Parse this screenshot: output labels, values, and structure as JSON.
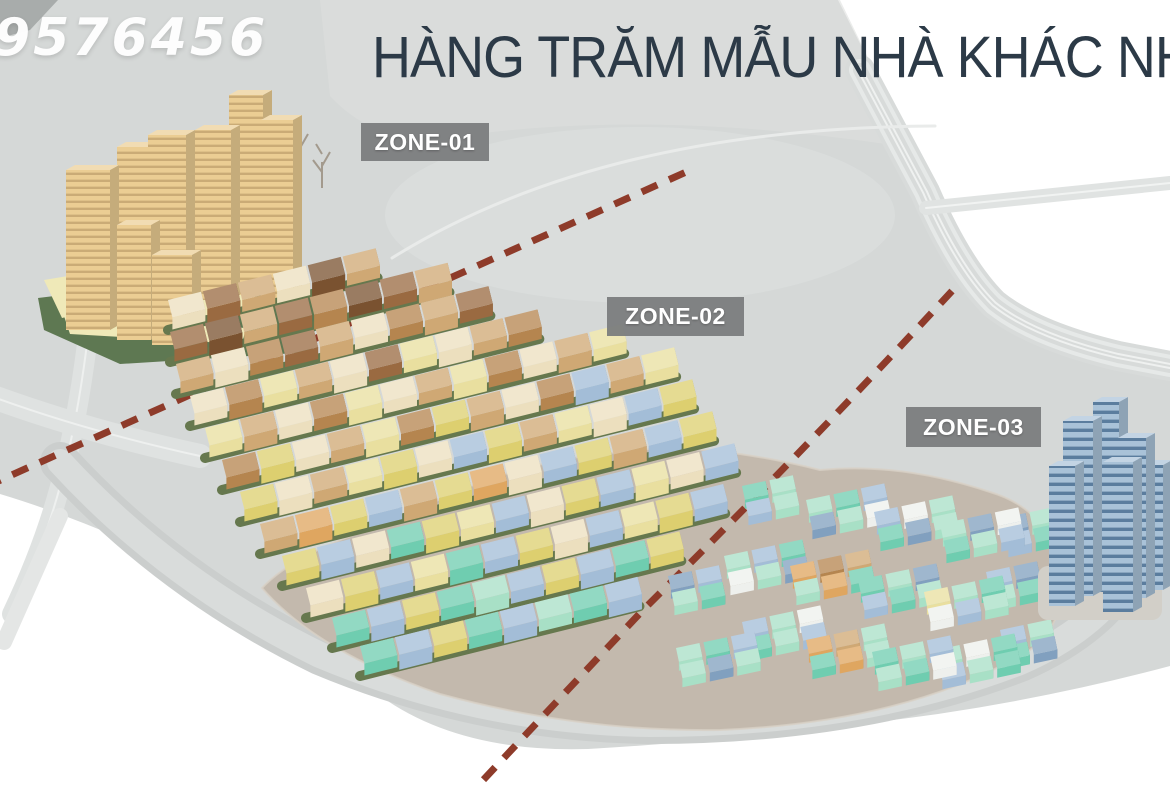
{
  "watermark": {
    "text": "9576456"
  },
  "title": {
    "text": "HÀNG TRĂM MẪU NHÀ KHÁC NHAU",
    "color": "#2c3a47"
  },
  "zone_labels": [
    {
      "id": "zone-01",
      "label": "ZONE-01"
    },
    {
      "id": "zone-02",
      "label": "ZONE-02"
    },
    {
      "id": "zone-03",
      "label": "ZONE-03"
    }
  ],
  "palette": {
    "cream": "#ecdfbe",
    "tan": "#cfa874",
    "caramel": "#b5854f",
    "brown": "#9a6a41",
    "chocolate": "#7a5230",
    "paleYellow": "#e9df9f",
    "yellow": "#ddcf6f",
    "blue": "#a3bdd7",
    "slate": "#81a0bf",
    "teal": "#6fcdb0",
    "mint": "#a8e0c6",
    "white": "#eef0ed",
    "orange": "#dfa660",
    "beige": "#ebcd93",
    "blueGlass": "#a9c2d8"
  },
  "scene": {
    "ground": {
      "plate": "M0,0 L838,0 L920,162 Q956,252 988,298 Q1028,334 1116,357 L1170,369 L1170,666 Q1058,696 938,714 Q758,739 588,749 Q455,753 375,692 Q288,640 178,564 Q80,518 0,494 Z",
      "plateColor": "#d5d8d7",
      "patches": [
        {
          "d": "M0,0 L58,0 L30,30 L0,38 Z",
          "fill": "#a8acab",
          "opacity": 1
        },
        {
          "d": "M320,0 L840,0 L912,148 Q660,108 460,136 Q380,150 330,96 Z",
          "fill": "#dddfde",
          "opacity": 0.6
        }
      ],
      "field": {
        "cx": 640,
        "cy": 215,
        "rx": 255,
        "ry": 88,
        "fill": "#dcdfde",
        "opacity": 0.7
      }
    },
    "roads": [
      {
        "d": "M860,70 L925,192 Q958,268 994,304 Q1034,336 1118,356 L1170,366",
        "layers": [
          [
            "#d8dbda",
            30
          ],
          [
            "#e6e9e8",
            22
          ],
          [
            "#d8dbda",
            14
          ],
          [
            "#eff1f0",
            6
          ],
          [
            "#d8dbda",
            2
          ]
        ]
      },
      {
        "d": "M926,208 L1170,183",
        "layers": [
          [
            "#e0e3e2",
            14
          ],
          [
            "#f1f3f2",
            2
          ]
        ]
      },
      {
        "d": "M96,256 Q86,380 66,462 Q50,534 12,614",
        "layers": [
          [
            "#dfe2e1",
            20
          ],
          [
            "#eef0ef",
            2
          ]
        ]
      },
      {
        "d": "M-4,398 Q90,432 200,456",
        "layers": [
          [
            "#dfe2e1",
            24
          ],
          [
            "#eef0ef",
            2
          ]
        ]
      },
      {
        "d": "M392,258 Q600,128 935,126",
        "layers": [
          [
            "#e9ebea",
            3
          ]
        ]
      },
      {
        "d": "M60,516 L4,642",
        "layers": [
          [
            "#e4e6e5",
            16
          ]
        ]
      },
      {
        "d": "M60,462 Q170,582 320,655 Q480,722 650,724 Q860,724 1020,662 Q1098,628 1130,572",
        "layers": [
          [
            "#cbcecd",
            40
          ],
          [
            "#d9dcdb",
            26
          ]
        ]
      }
    ],
    "podium": {
      "d": "M262,588 Q318,652 440,694 Q580,732 720,730 Q910,722 1030,650 Q1068,622 1060,570 Q1050,510 990,492 Q900,462 820,470 Q700,440 620,452 Q500,462 400,520 Q300,548 262,588 Z",
      "fill": "#c3b9ad"
    },
    "towerBase": {
      "green": "M38,298 L250,272 L318,300 L312,352 L120,364 L44,330 Z",
      "greenColor": "#5e7852",
      "slabs": [
        "M44,280 L116,268 L128,302 L62,318 Z",
        "M148,296 L252,288 L260,310 L156,320 Z",
        "M64,316 L246,328 L242,344 L70,334 Z"
      ],
      "slabColor": "#efe9b8"
    },
    "boundaries": {
      "color": "#8e3b2a",
      "width": 7,
      "dash": "17 13",
      "lines": [
        {
          "d": "M-15,487 L695,168"
        },
        {
          "d": "M952,291 Q800,455 645,608 Q558,700 472,792"
        }
      ]
    },
    "trees": [
      {
        "x": 300,
        "y": 170
      },
      {
        "x": 322,
        "y": 188
      },
      {
        "x": 290,
        "y": 205
      }
    ],
    "beigeTowers": [
      {
        "cx": 246,
        "base": 295,
        "w": 34,
        "h": 200
      },
      {
        "cx": 277,
        "base": 300,
        "w": 32,
        "h": 180
      },
      {
        "cx": 213,
        "base": 300,
        "w": 36,
        "h": 170
      },
      {
        "cx": 135,
        "base": 302,
        "w": 36,
        "h": 155
      },
      {
        "cx": 167,
        "base": 320,
        "w": 38,
        "h": 185
      },
      {
        "cx": 88,
        "base": 330,
        "w": 44,
        "h": 160
      },
      {
        "cx": 134,
        "base": 340,
        "w": 34,
        "h": 115
      },
      {
        "cx": 172,
        "base": 345,
        "w": 40,
        "h": 90
      }
    ],
    "rowAngle": -14,
    "house": {
      "w": 34,
      "d": 18,
      "h": 12,
      "gap": 2
    },
    "rows": [
      {
        "x": 168,
        "y": 300,
        "n": 6,
        "pal": [
          "cream",
          "brown",
          "tan",
          "cream",
          "chocolate",
          "tan"
        ]
      },
      {
        "x": 170,
        "y": 332,
        "n": 8,
        "pal": [
          "brown",
          "chocolate",
          "tan",
          "brown",
          "caramel",
          "chocolate",
          "brown",
          "tan"
        ]
      },
      {
        "x": 176,
        "y": 364,
        "n": 9,
        "pal": [
          "tan",
          "cream",
          "caramel",
          "brown",
          "tan",
          "cream",
          "caramel",
          "tan",
          "brown"
        ]
      },
      {
        "x": 190,
        "y": 396,
        "n": 10,
        "pal": [
          "cream",
          "caramel",
          "paleYellow",
          "tan",
          "cream",
          "brown",
          "paleYellow",
          "cream",
          "tan",
          "caramel"
        ]
      },
      {
        "x": 205,
        "y": 428,
        "n": 12,
        "pal": [
          "paleYellow",
          "tan",
          "cream",
          "caramel",
          "paleYellow",
          "cream",
          "tan",
          "paleYellow",
          "caramel",
          "cream",
          "tan",
          "paleYellow"
        ]
      },
      {
        "x": 222,
        "y": 460,
        "n": 13,
        "pal": [
          "caramel",
          "yellow",
          "cream",
          "tan",
          "paleYellow",
          "caramel",
          "yellow",
          "tan",
          "cream",
          "caramel",
          "blue",
          "tan",
          "paleYellow"
        ]
      },
      {
        "x": 240,
        "y": 492,
        "n": 13,
        "pal": [
          "yellow",
          "cream",
          "tan",
          "paleYellow",
          "yellow",
          "cream",
          "blue",
          "yellow",
          "tan",
          "paleYellow",
          "cream",
          "blue",
          "yellow"
        ]
      },
      {
        "x": 260,
        "y": 524,
        "n": 13,
        "pal": [
          "tan",
          "orange",
          "yellow",
          "blue",
          "tan",
          "yellow",
          "orange",
          "cream",
          "blue",
          "yellow",
          "tan",
          "blue",
          "yellow"
        ]
      },
      {
        "x": 282,
        "y": 556,
        "n": 13,
        "pal": [
          "yellow",
          "blue",
          "cream",
          "teal",
          "yellow",
          "paleYellow",
          "blue",
          "cream",
          "yellow",
          "blue",
          "paleYellow",
          "cream",
          "blue"
        ]
      },
      {
        "x": 306,
        "y": 588,
        "n": 12,
        "pal": [
          "cream",
          "yellow",
          "blue",
          "paleYellow",
          "teal",
          "blue",
          "yellow",
          "cream",
          "blue",
          "paleYellow",
          "yellow",
          "blue"
        ]
      },
      {
        "x": 332,
        "y": 618,
        "n": 10,
        "pal": [
          "teal",
          "blue",
          "yellow",
          "teal",
          "mint",
          "blue",
          "yellow",
          "blue",
          "teal",
          "yellow"
        ]
      },
      {
        "x": 360,
        "y": 646,
        "n": 8,
        "pal": [
          "teal",
          "blue",
          "yellow",
          "teal",
          "blue",
          "mint",
          "teal",
          "blue"
        ]
      }
    ],
    "clusterAngle": -12,
    "clusterHouse": {
      "w": 24,
      "d": 14,
      "h": 9,
      "sx": 28,
      "sy": 17
    },
    "clusters": [
      {
        "x": 676,
        "y": 648,
        "cols": 3,
        "rows": 2,
        "pal": [
          "mint",
          "teal",
          "blue",
          "mint",
          "slate",
          "mint"
        ]
      },
      {
        "x": 742,
        "y": 622,
        "cols": 3,
        "rows": 2,
        "pal": [
          "blue",
          "mint",
          "white",
          "teal",
          "mint",
          "blue"
        ]
      },
      {
        "x": 806,
        "y": 640,
        "cols": 3,
        "rows": 2,
        "pal": [
          "orange",
          "tan",
          "mint",
          "teal",
          "orange",
          "mint"
        ]
      },
      {
        "x": 872,
        "y": 652,
        "cols": 3,
        "rows": 2,
        "pal": [
          "teal",
          "mint",
          "blue",
          "mint",
          "teal",
          "white"
        ]
      },
      {
        "x": 936,
        "y": 650,
        "cols": 3,
        "rows": 2,
        "pal": [
          "mint",
          "white",
          "teal",
          "blue",
          "mint",
          "teal"
        ]
      },
      {
        "x": 1000,
        "y": 630,
        "cols": 2,
        "rows": 2,
        "pal": [
          "blue",
          "mint",
          "teal",
          "slate"
        ]
      },
      {
        "x": 668,
        "y": 576,
        "cols": 2,
        "rows": 2,
        "pal": [
          "slate",
          "blue",
          "mint",
          "teal"
        ]
      },
      {
        "x": 724,
        "y": 556,
        "cols": 3,
        "rows": 2,
        "pal": [
          "mint",
          "blue",
          "teal",
          "white",
          "mint",
          "slate"
        ]
      },
      {
        "x": 790,
        "y": 566,
        "cols": 3,
        "rows": 2,
        "pal": [
          "orange",
          "caramel",
          "tan",
          "mint",
          "orange",
          "teal"
        ]
      },
      {
        "x": 858,
        "y": 580,
        "cols": 3,
        "rows": 2,
        "pal": [
          "teal",
          "mint",
          "slate",
          "blue",
          "teal",
          "mint"
        ]
      },
      {
        "x": 924,
        "y": 592,
        "cols": 3,
        "rows": 2,
        "pal": [
          "paleYellow",
          "mint",
          "teal",
          "white",
          "blue",
          "mint"
        ]
      },
      {
        "x": 986,
        "y": 572,
        "cols": 2,
        "rows": 2,
        "pal": [
          "blue",
          "slate",
          "mint",
          "teal"
        ]
      },
      {
        "x": 806,
        "y": 500,
        "cols": 3,
        "rows": 2,
        "pal": [
          "mint",
          "teal",
          "blue",
          "slate",
          "mint",
          "white"
        ]
      },
      {
        "x": 874,
        "y": 512,
        "cols": 3,
        "rows": 2,
        "pal": [
          "blue",
          "white",
          "mint",
          "teal",
          "slate",
          "mint"
        ]
      },
      {
        "x": 940,
        "y": 524,
        "cols": 3,
        "rows": 2,
        "pal": [
          "mint",
          "slate",
          "white",
          "teal",
          "mint",
          "blue"
        ]
      },
      {
        "x": 1002,
        "y": 518,
        "cols": 2,
        "rows": 2,
        "pal": [
          "slate",
          "mint",
          "blue",
          "teal"
        ]
      },
      {
        "x": 742,
        "y": 486,
        "cols": 2,
        "rows": 2,
        "pal": [
          "teal",
          "mint",
          "blue",
          "mint"
        ]
      }
    ],
    "blueTowers": {
      "podium": {
        "x": 1038,
        "y": 566,
        "w": 124,
        "h": 54,
        "fill": "#d2cfc8"
      },
      "towers": [
        {
          "cx": 1078,
          "base": 596,
          "w": 30,
          "h": 175
        },
        {
          "cx": 1106,
          "base": 592,
          "w": 26,
          "h": 190
        },
        {
          "cx": 1132,
          "base": 598,
          "w": 28,
          "h": 160
        },
        {
          "cx": 1152,
          "base": 590,
          "w": 22,
          "h": 125
        },
        {
          "cx": 1062,
          "base": 606,
          "w": 26,
          "h": 140
        },
        {
          "cx": 1118,
          "base": 612,
          "w": 30,
          "h": 150
        }
      ],
      "bandColor": "#5b7d9e"
    }
  }
}
